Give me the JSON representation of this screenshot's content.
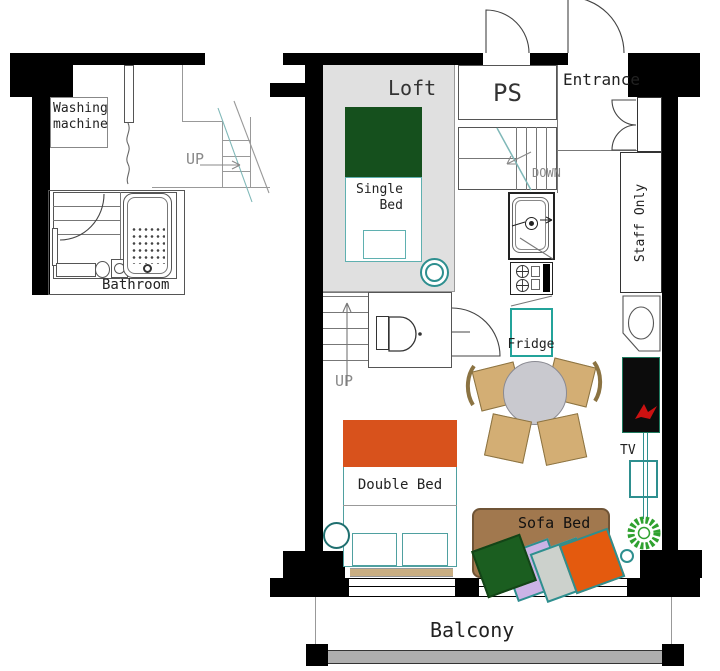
{
  "rooms": {
    "loft": "Loft",
    "ps": "PS",
    "entrance": "Entrance",
    "bathroom": "Bathroom",
    "balcony": "Balcony",
    "staff_only": "Staff Only"
  },
  "furniture": {
    "single_bed": {
      "line1": "Single",
      "line2": "Bed"
    },
    "double_bed": "Double Bed",
    "sofa_bed": "Sofa Bed",
    "fridge": "Fridge",
    "tv": "TV",
    "washing_machine": {
      "line1": "Washing",
      "line2": "machine"
    }
  },
  "stairs": {
    "up_left": "UP",
    "up_main": "UP",
    "down": "DOWN"
  },
  "colors": {
    "wall": "#000000",
    "loft_floor": "#e0e0e0",
    "single_bed_green": "#15501d",
    "double_bed_orange": "#d8521c",
    "sofa_brown": "#a1784e",
    "cushion_green": "#1b5e20",
    "cushion_lavender": "#cbb3e6",
    "cushion_gray": "#ccd1cc",
    "cushion_orange": "#e45a0e",
    "chair_tan": "#d3ae74",
    "table_gray": "#c9c9cf",
    "teal_outline": "#2e8f8f",
    "plant_green": "#2fa12f",
    "tv_logo_red": "#cc1111",
    "railing_gray": "#aeaeae",
    "bed_skirt_tan": "#c9ae82"
  }
}
